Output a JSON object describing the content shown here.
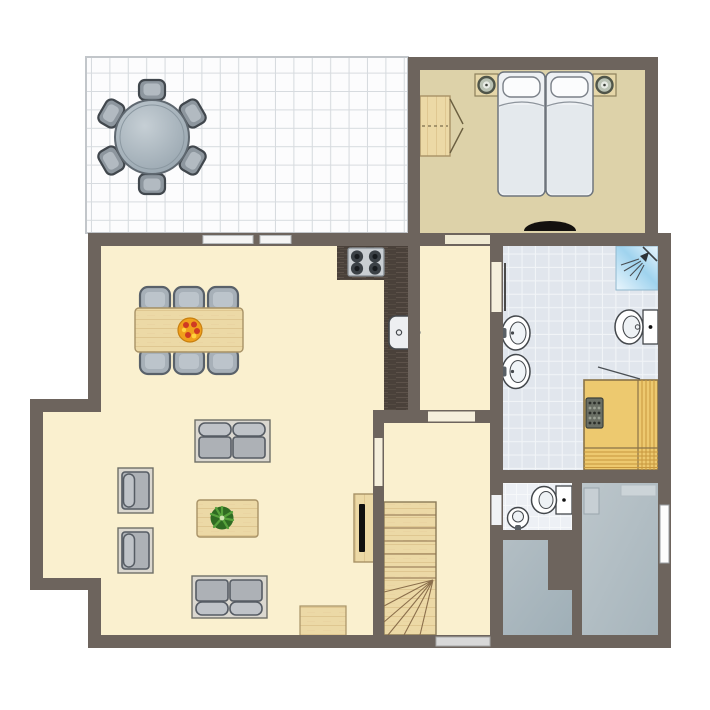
{
  "title": "holiday-home-ground-floor-plan",
  "palette": {
    "wall": "#6d645d",
    "living_floor": "#faf0cf",
    "terrace_floor": "#fcfcfd",
    "terrace_grid": "#d7dbdf",
    "terrace_edge": "#c2c6ca",
    "bedroom_floor": "#ddd2a9",
    "bath_floor": "#e1e6ed",
    "bath_grid": "#f1f4f7",
    "wc_floor": "#edf0f5",
    "wc_grid": "#f7f9fb",
    "gray_room_a": "#b3bec4",
    "gray_room_b": "#9fafb7",
    "gray_room_c": "#bcc6cb",
    "gray_room_d": "#a7b5bc",
    "wood_light": "#ecd9a6",
    "wood_grain": "#d3b47c",
    "wood_edge": "#a89266",
    "counter_dark": "#4a413a",
    "counter_grain": "#5f544b",
    "stove_body": "#c9ced2",
    "burner_dark": "#3b4146",
    "cushion_gray": "#adb1b6",
    "cushion_light": "#bfc3c8",
    "cushion_border": "#565c64",
    "frame_light": "#dbd8d0",
    "chair_gray": "#a7b0b8",
    "chair_border": "#59616a",
    "fixture_white": "#ffffff",
    "fixture_outline": "#44484c",
    "shower_blue_1": "#9fd3ee",
    "shower_blue_2": "#eaf6fd",
    "sauna_wood": "#edc96f",
    "sauna_stripe": "#c8983e",
    "sauna_edge": "#8a7347",
    "heater_body": "#6a6f65",
    "table_top_1": "#c6cfd5",
    "table_top_2": "#93a1ab",
    "window_bar": "#f4f4f4",
    "door_bar": "#d8d8d8",
    "mat_black": "#14110e",
    "fruit_orange": "#f0a01c",
    "fruit_red": "#cf3a23",
    "fruit_yellow": "#ffd23e",
    "plant_dark": "#2f6b22",
    "plant_leaf": "#57a23c",
    "tv_black": "#101010"
  },
  "rooms": [
    {
      "name": "terrace",
      "floor": "white-tile-grid"
    },
    {
      "name": "bedroom",
      "floor": "tan"
    },
    {
      "name": "living-dining-room",
      "floor": "cream"
    },
    {
      "name": "kitchen",
      "floor": "cream"
    },
    {
      "name": "hallway",
      "floor": "cream"
    },
    {
      "name": "bathroom",
      "floor": "light-blue-tile"
    },
    {
      "name": "sauna",
      "floor": "yellow-wood"
    },
    {
      "name": "wc",
      "floor": "white-tile"
    },
    {
      "name": "stair-hall",
      "floor": "cream"
    },
    {
      "name": "storage-room-left",
      "floor": "gray"
    },
    {
      "name": "storage-room-right",
      "floor": "gray"
    }
  ],
  "furniture": {
    "terrace": [
      "round-table",
      "chair x6"
    ],
    "bedroom": [
      "double-bed",
      "pillow x2",
      "nightstand-with-lamp x2",
      "wardrobe",
      "black-doormat"
    ],
    "kitchen": [
      "l-shaped-counter",
      "cooktop-4-burners",
      "kitchen-sink"
    ],
    "living_dining": [
      "dining-table",
      "dining-chair x6",
      "fruit-bowl",
      "sofa x2",
      "armchair x2",
      "coffee-table",
      "potted-plant",
      "tv-cabinet",
      "tv",
      "wooden-doormat"
    ],
    "bathroom": [
      "shower-corner",
      "toilet",
      "washbasin x2",
      "sauna-with-heater"
    ],
    "wc": [
      "toilet",
      "washbasin"
    ],
    "stair_hall": [
      "staircase-with-winders",
      "front-door-mat"
    ],
    "storage_right": [
      "doormat",
      "cabinet"
    ]
  },
  "openings": [
    "terrace-window x2",
    "bedroom-door",
    "bathroom-door",
    "hall-door",
    "living-stairhall-door",
    "wc-door",
    "front-door",
    "storage-window"
  ]
}
